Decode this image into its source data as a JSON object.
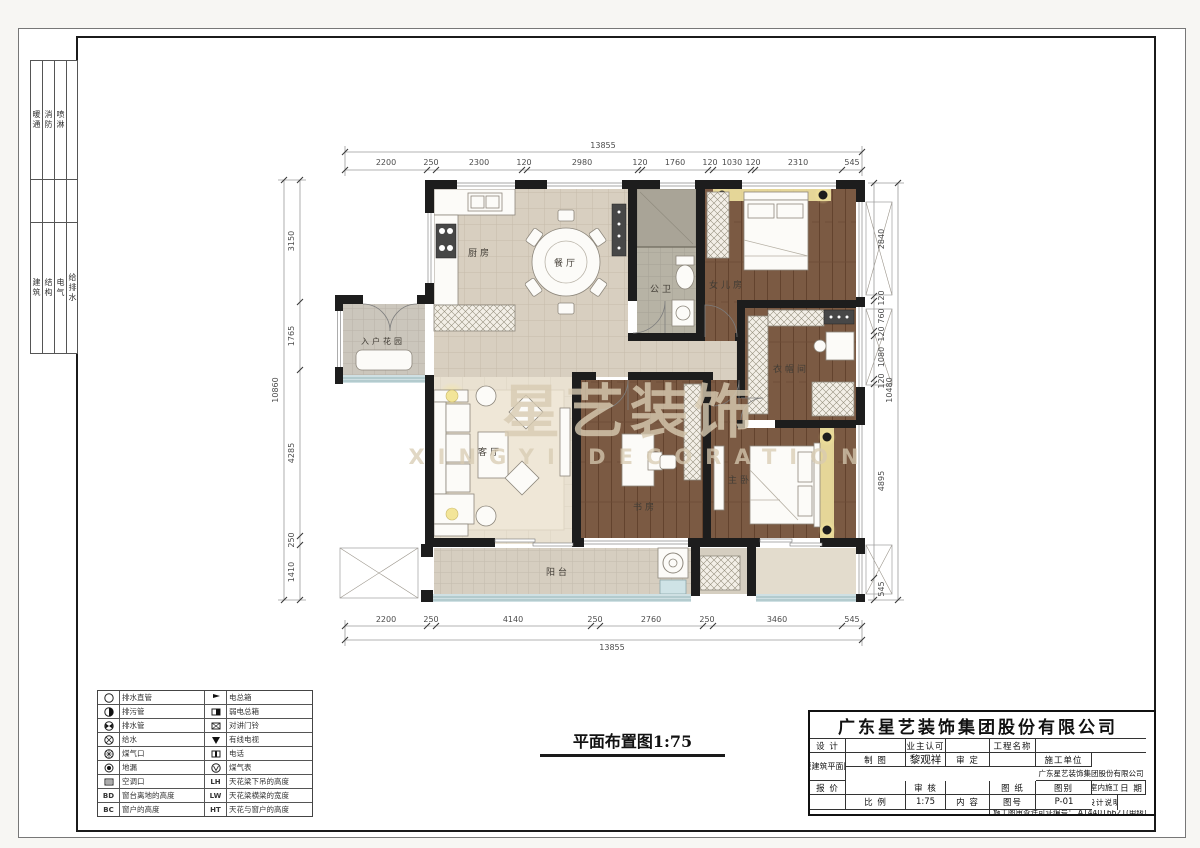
{
  "frame": {
    "side_groups": [
      {
        "items": [
          "暖通",
          "消防",
          "喷淋",
          ""
        ]
      },
      {
        "items": [
          "建筑",
          "结构",
          "电气",
          "给排水"
        ]
      }
    ]
  },
  "plan": {
    "caption": "平面布置图1:75",
    "watermark": {
      "cn": "星艺装饰",
      "en": "XINGYI DECORATION"
    },
    "rooms": {
      "kitchen": "厨房",
      "dining": "餐厅",
      "bath": "公卫",
      "daughter": "女儿房",
      "entry": "入户花园",
      "living": "客厅",
      "cloak": "衣帽间",
      "study": "书房",
      "master": "主卧",
      "balcony": "阳台"
    },
    "dims": {
      "top": {
        "total": "13855",
        "segments": [
          "2200",
          "250",
          "2300",
          "120",
          "2980",
          "120",
          "1760",
          "120",
          "1030",
          "120",
          "2310",
          "545"
        ]
      },
      "bottom": {
        "total": "13855",
        "segments": [
          "2200",
          "250",
          "4140",
          "250",
          "2760",
          "250",
          "3460",
          "545"
        ]
      },
      "left": {
        "total": "10860",
        "segments": [
          "3150",
          "1765",
          "4285",
          "250",
          "1410"
        ]
      },
      "right": {
        "total": "10480",
        "segments": [
          "2840",
          "120",
          "760",
          "120",
          "1080",
          "120",
          "4895",
          "545"
        ]
      }
    }
  },
  "legend": {
    "rows": [
      {
        "lc": "",
        "ll": "排水直管",
        "rc": "",
        "rl": "电总箱"
      },
      {
        "lc": "",
        "ll": "排污管",
        "rc": "",
        "rl": "弱电总箱"
      },
      {
        "lc": "",
        "ll": "排水管",
        "rc": "",
        "rl": "对讲门铃"
      },
      {
        "lc": "",
        "ll": "给水",
        "rc": "",
        "rl": "有线电视"
      },
      {
        "lc": "",
        "ll": "煤气口",
        "rc": "",
        "rl": "电话"
      },
      {
        "lc": "",
        "ll": "地漏",
        "rc": "",
        "rl": "煤气表"
      },
      {
        "lc": "",
        "ll": "空调口",
        "rc": "LH",
        "rl": "天花梁下吊的高度"
      },
      {
        "lc": "BD",
        "ll": "窗台离地的高度",
        "rc": "LW",
        "rl": "天花梁横梁的宽度"
      },
      {
        "lc": "BC",
        "ll": "窗户的高度",
        "rc": "HT",
        "rl": "天花与窗户的高度"
      }
    ]
  },
  "title_block": {
    "company": "广东星艺装饰集团股份有限公司",
    "design_label": "设 计",
    "design": "",
    "draft_label": "制 图",
    "draft": "黎观祥",
    "quote_label": "报 价",
    "quote": "",
    "date_label": "日 期",
    "date": "",
    "owner_label": "业主认可",
    "owner": "",
    "approve_label": "审 定",
    "approve": "",
    "review_label": "审 核",
    "review": "",
    "scale_label": "比 例",
    "scale": "1:75",
    "project_label": "工程名称",
    "project": "",
    "builder_label": "施工单位",
    "builder": "广东星艺装饰集团股份有限公司",
    "sheet_label": "图 纸",
    "content_label": "内 容",
    "sheet_content": "原建筑平面图",
    "cat_label": "图别",
    "cat": "室内施工",
    "no_label": "图号",
    "no": "P-01",
    "notes_label": "设计说明",
    "permit": "施工图审查许可证编号：  A144016621(甲级)"
  }
}
